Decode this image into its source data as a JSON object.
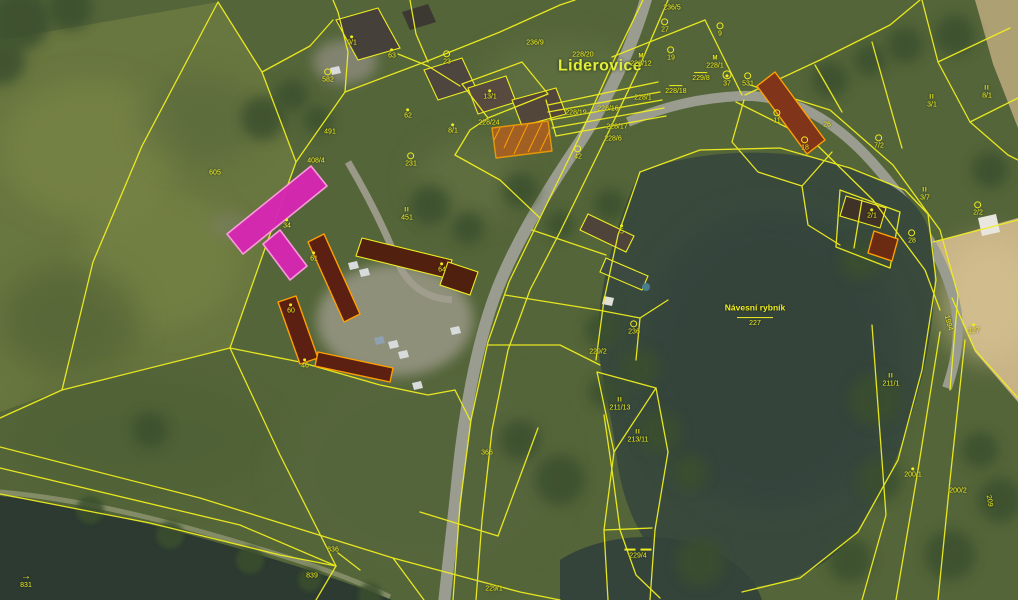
{
  "map": {
    "village_name": "Liderovice",
    "pond_name": "Návesní rybník",
    "pond_parcel": "227",
    "selected_parcel": "34",
    "colors": {
      "parcel_line": "#f0ee20",
      "label_text": "#f0ee20",
      "selected_fill": "#d826b4",
      "selected_stroke": "#ff9fe0",
      "building_outline_orange": "#ffa000",
      "building_fill_dark": "#5c2012",
      "water": "#394a3d",
      "field_tan": "#c7b385",
      "road_gray": "#999c8e",
      "grass_green": "#546539"
    },
    "labels": [
      {
        "t": "Liderovice",
        "x": 600,
        "y": 67,
        "cls": "place"
      },
      {
        "t": "Návesní rybník",
        "x": 755,
        "y": 308,
        "cls": "pond-name"
      },
      {
        "t": "227",
        "x": 755,
        "y": 322,
        "sym": "bartop"
      },
      {
        "t": "9/1",
        "x": 352,
        "y": 41,
        "sym": "dot"
      },
      {
        "t": "63",
        "x": 392,
        "y": 54,
        "sym": "dot"
      },
      {
        "t": "582",
        "x": 328,
        "y": 76,
        "sym": "circle"
      },
      {
        "t": "23",
        "x": 447,
        "y": 58,
        "sym": "circle"
      },
      {
        "t": "13/1",
        "x": 490,
        "y": 95,
        "sym": "dot"
      },
      {
        "t": "62",
        "x": 408,
        "y": 114,
        "sym": "dot"
      },
      {
        "t": "8/1",
        "x": 453,
        "y": 129,
        "sym": "dot"
      },
      {
        "t": "228/24",
        "x": 489,
        "y": 123
      },
      {
        "t": "491",
        "x": 330,
        "y": 132
      },
      {
        "t": "605",
        "x": 215,
        "y": 173
      },
      {
        "t": "408/4",
        "x": 316,
        "y": 161
      },
      {
        "t": "231",
        "x": 411,
        "y": 160,
        "sym": "circle"
      },
      {
        "t": "451",
        "x": 407,
        "y": 215,
        "sym": "II"
      },
      {
        "t": "34",
        "x": 287,
        "y": 224,
        "sym": "dot",
        "cls": "on-sel"
      },
      {
        "t": "61",
        "x": 314,
        "y": 257,
        "sym": "dot"
      },
      {
        "t": "60",
        "x": 291,
        "y": 309,
        "sym": "dot"
      },
      {
        "t": "46",
        "x": 305,
        "y": 364,
        "sym": "dot"
      },
      {
        "t": "64",
        "x": 442,
        "y": 268,
        "sym": "dot"
      },
      {
        "t": "42",
        "x": 578,
        "y": 153,
        "sym": "circle"
      },
      {
        "t": "228/20",
        "x": 583,
        "y": 55
      },
      {
        "t": "228/12",
        "x": 641,
        "y": 61,
        "sym": "M"
      },
      {
        "t": "228/1",
        "x": 643,
        "y": 98
      },
      {
        "t": "228/16",
        "x": 608,
        "y": 109
      },
      {
        "t": "228/19",
        "x": 576,
        "y": 113
      },
      {
        "t": "228/17",
        "x": 617,
        "y": 127
      },
      {
        "t": "228/6",
        "x": 613,
        "y": 139
      },
      {
        "t": "228/18",
        "x": 676,
        "y": 90,
        "sym": "bar"
      },
      {
        "t": "229/8",
        "x": 701,
        "y": 77,
        "sym": "bar"
      },
      {
        "t": "228/1",
        "x": 715,
        "y": 63,
        "sym": "M"
      },
      {
        "t": "37",
        "x": 727,
        "y": 79,
        "sym": "ring"
      },
      {
        "t": "531",
        "x": 748,
        "y": 80,
        "sym": "circle"
      },
      {
        "t": "27",
        "x": 665,
        "y": 26,
        "sym": "circle"
      },
      {
        "t": "9",
        "x": 720,
        "y": 30,
        "sym": "circle"
      },
      {
        "t": "19",
        "x": 671,
        "y": 54,
        "sym": "circle"
      },
      {
        "t": "236/5",
        "x": 672,
        "y": 8
      },
      {
        "t": "236/9",
        "x": 535,
        "y": 43
      },
      {
        "t": "11",
        "x": 777,
        "y": 117,
        "sym": "circle"
      },
      {
        "t": "26",
        "x": 827,
        "y": 125
      },
      {
        "t": "18",
        "x": 805,
        "y": 144,
        "sym": "circle"
      },
      {
        "t": "7/2",
        "x": 879,
        "y": 142,
        "sym": "circle"
      },
      {
        "t": "3/1",
        "x": 932,
        "y": 102,
        "sym": "II"
      },
      {
        "t": "2/1",
        "x": 872,
        "y": 214,
        "sym": "dot"
      },
      {
        "t": "3/7",
        "x": 925,
        "y": 195,
        "sym": "II"
      },
      {
        "t": "2/2",
        "x": 978,
        "y": 209,
        "sym": "circle"
      },
      {
        "t": "28",
        "x": 912,
        "y": 237,
        "sym": "circle"
      },
      {
        "t": "8/1",
        "x": 987,
        "y": 93,
        "sym": "II"
      },
      {
        "t": "127",
        "x": 974,
        "y": 329,
        "sym": "dot"
      },
      {
        "t": "1994",
        "x": 948,
        "y": 323,
        "rot": 75
      },
      {
        "t": "211/1",
        "x": 891,
        "y": 381,
        "sym": "II"
      },
      {
        "t": "200/1",
        "x": 913,
        "y": 473,
        "sym": "dot"
      },
      {
        "t": "200/2",
        "x": 958,
        "y": 491
      },
      {
        "t": "209",
        "x": 989,
        "y": 501,
        "rot": 80
      },
      {
        "t": "229/2",
        "x": 598,
        "y": 352
      },
      {
        "t": "236",
        "x": 634,
        "y": 328,
        "sym": "circle"
      },
      {
        "t": "5",
        "x": 622,
        "y": 230,
        "sym": "dot"
      },
      {
        "t": "211/13",
        "x": 620,
        "y": 405,
        "sym": "II"
      },
      {
        "t": "213/11",
        "x": 638,
        "y": 437,
        "sym": "II"
      },
      {
        "t": "366",
        "x": 487,
        "y": 453
      },
      {
        "t": "229/1",
        "x": 494,
        "y": 589
      },
      {
        "t": "229/4",
        "x": 638,
        "y": 554,
        "sym": "bar2"
      },
      {
        "t": "836",
        "x": 333,
        "y": 550
      },
      {
        "t": "839",
        "x": 312,
        "y": 576
      },
      {
        "t": "831",
        "x": 26,
        "y": 581,
        "sym": "arrow"
      }
    ]
  }
}
